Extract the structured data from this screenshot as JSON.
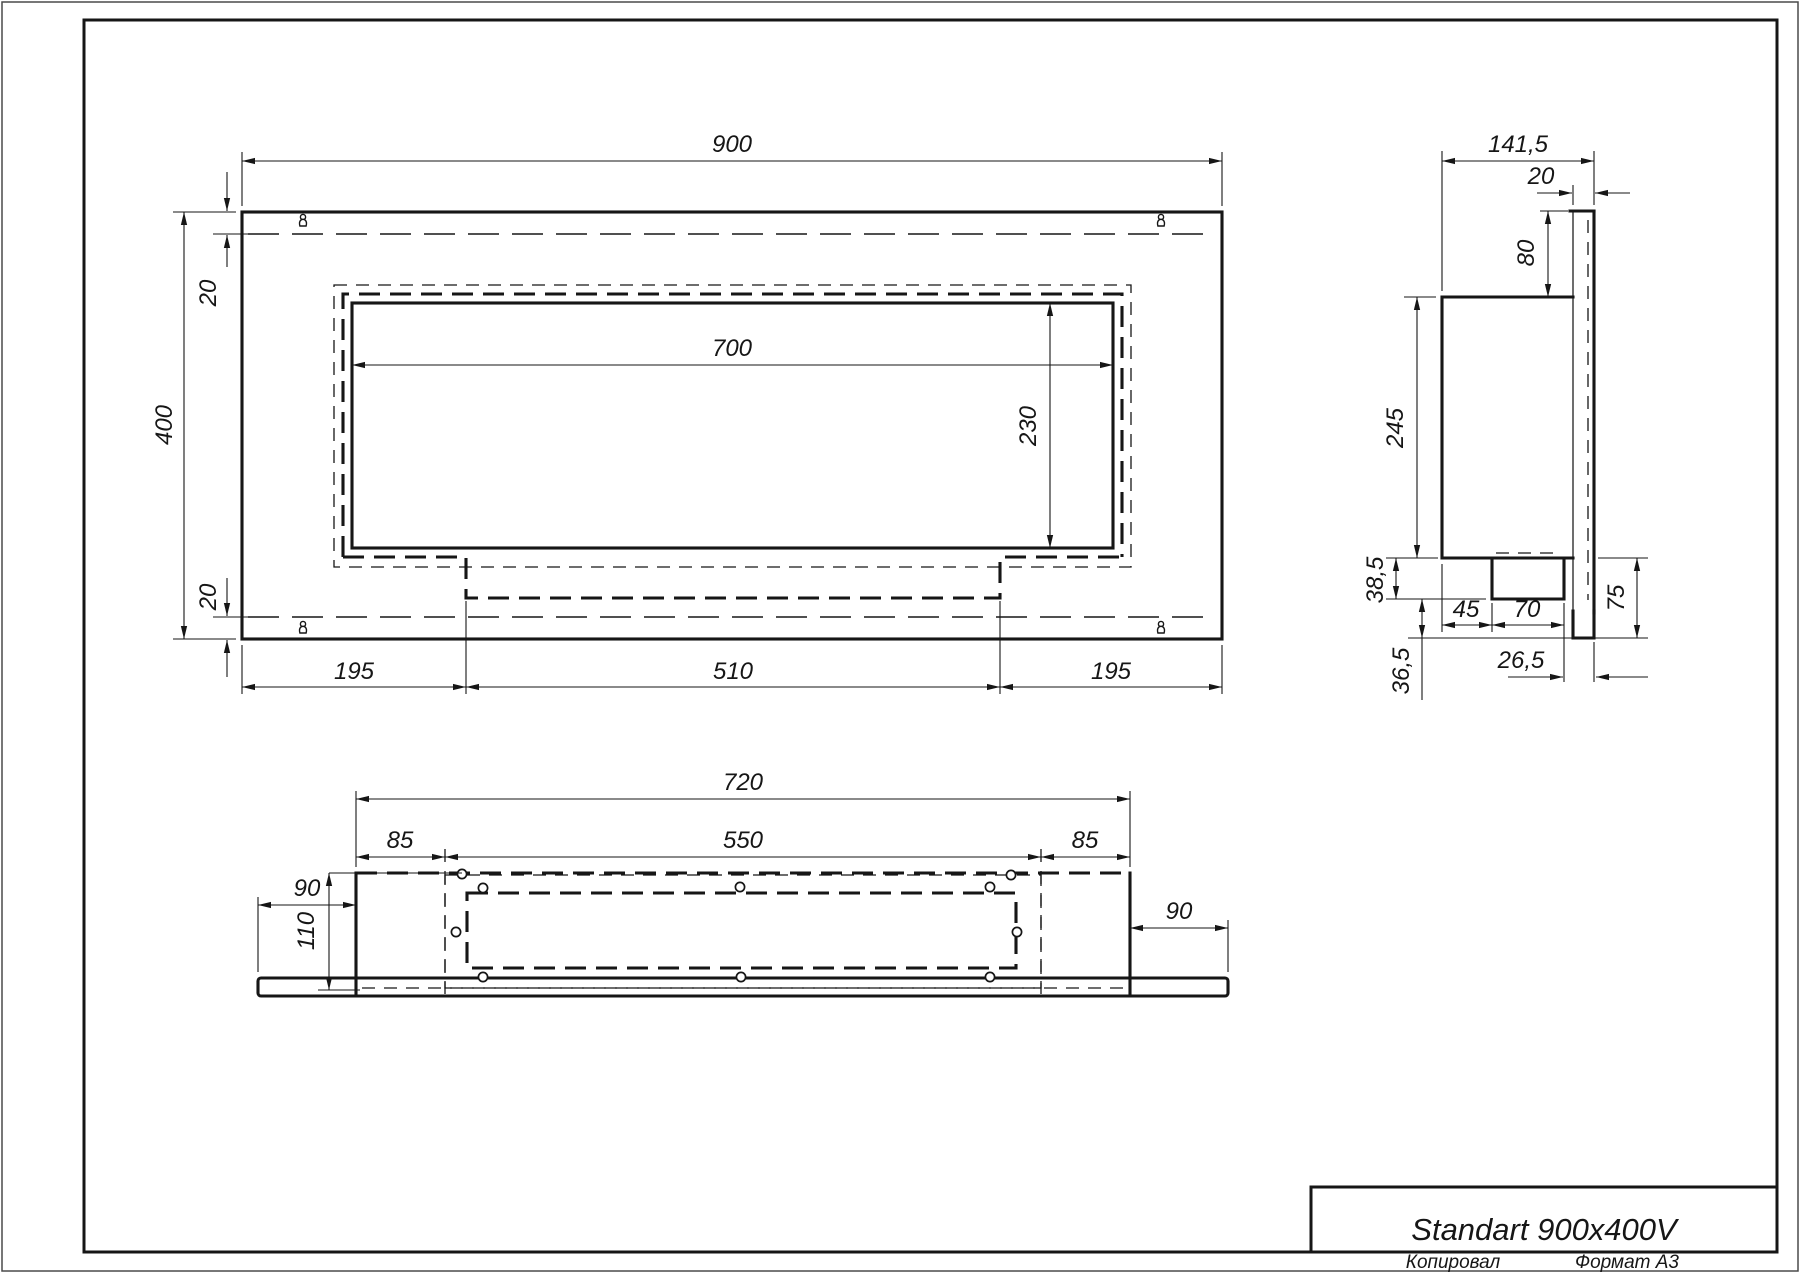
{
  "title_block": {
    "model": "Standart 900x400V"
  },
  "page": {
    "copied_label": "Копировал",
    "format_label": "Формат А3"
  },
  "front_view": {
    "width": "900",
    "height": "400",
    "gap_top": "20",
    "gap_bottom": "20",
    "opening_width": "700",
    "opening_height": "230",
    "seg_left": "195",
    "seg_center": "510",
    "seg_right": "195"
  },
  "side_view": {
    "depth": "141,5",
    "plate_thickness": "20",
    "back_above": "80",
    "body_height": "245",
    "tray_drop": "38,5",
    "hook_drop": "36,5",
    "tray_offset": "45",
    "tray_width": "70",
    "back_below": "75",
    "hook_inset": "26,5"
  },
  "bottom_view": {
    "width": "720",
    "inset_left": "85",
    "cutout_width": "550",
    "inset_right": "85",
    "wing_left": "90",
    "wing_right": "90",
    "depth": "110"
  }
}
